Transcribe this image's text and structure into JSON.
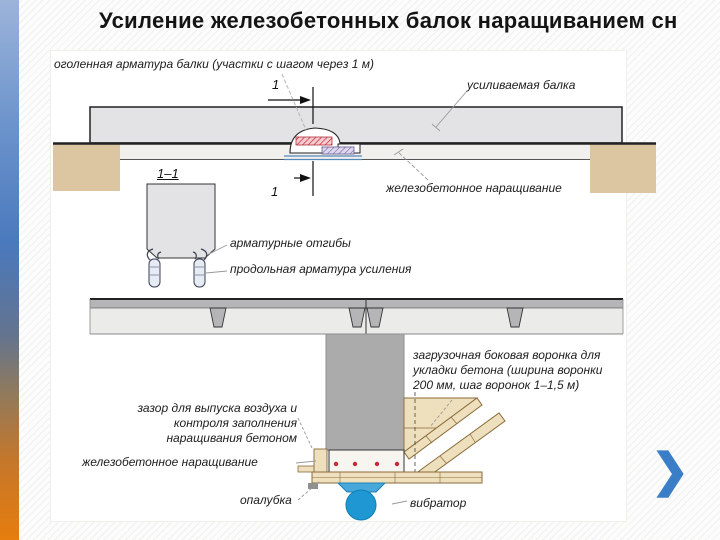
{
  "slide": {
    "title": "Усиление железобетонных балок наращиванием сн",
    "nav": {
      "next_chevron": "❯"
    }
  },
  "elevation": {
    "label_exposed_rebar": "оголенная арматура балки (участки с шагом через 1 м)",
    "label_strengthened_beam": "усиливаемая балка",
    "label_rc_buildup": "железобетонное наращивание",
    "section_mark_top": "1",
    "section_mark_bottom": "1"
  },
  "section_1_1": {
    "title": "1–1",
    "label_rebar_bends": "арматурные отгибы",
    "label_longitudinal_rebar": "продольная арматура усиления"
  },
  "cross_section": {
    "label_loading_funnel": "загрузочная боковая воронка для укладки бетона (ширина воронки 200 мм, шаг воронок 1–1,5 м)",
    "label_air_gap": "зазор для выпуска воздуха и контроля заполнения наращивания бетоном",
    "label_rc_buildup": "железобетонное наращивание",
    "label_formwork": "опалубка",
    "label_vibrator": "вибратор"
  },
  "colors": {
    "accent_strip_top": "#6e95cc",
    "accent_strip_bottom": "#e67d0e",
    "chevron_blue": "#3b7ec8",
    "support_tan": "#dcc6a2",
    "formwork_tan": "#eedfbd",
    "beam_gray": "#e3e3e5",
    "column_gray": "#ababab",
    "rebar_dot_red": "#c8273a",
    "vibrator_blue": "#2f9fd6"
  }
}
